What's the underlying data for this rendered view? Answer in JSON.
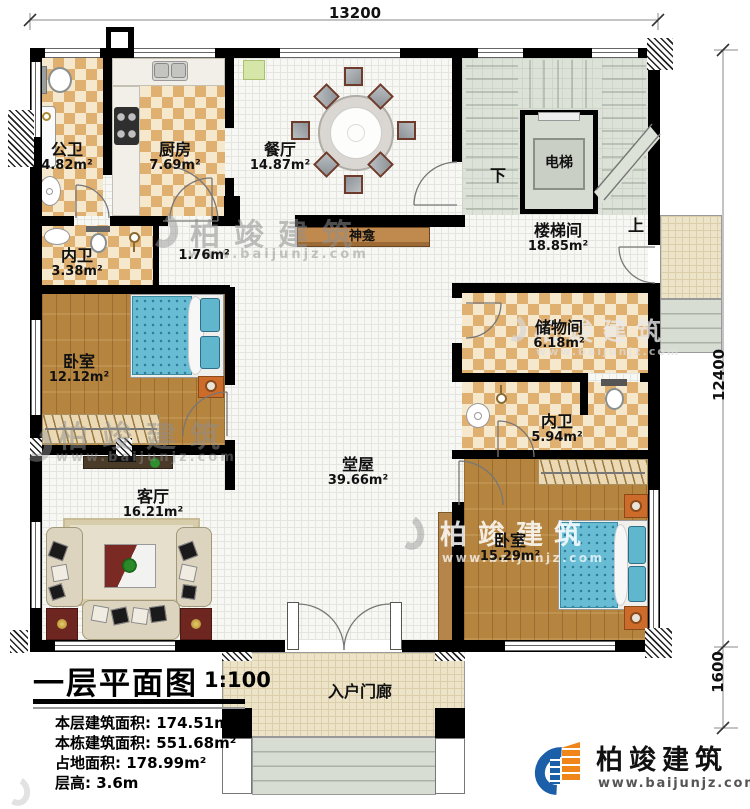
{
  "dimensions": {
    "top": "13200",
    "side": "12400",
    "porch": "1600"
  },
  "rooms": {
    "gongwei": {
      "name": "公卫",
      "area": "4.82m²"
    },
    "chufang": {
      "name": "厨房",
      "area": "7.69m²"
    },
    "canting": {
      "name": "餐厅",
      "area": "14.87m²"
    },
    "neiwei1": {
      "name": "内卫",
      "area": "3.38m²"
    },
    "shenkan": {
      "name": "神龛",
      "area": "1.76m²"
    },
    "woshi1": {
      "name": "卧室",
      "area": "12.12m²"
    },
    "keting": {
      "name": "客厅",
      "area": "16.21m²"
    },
    "tangwu": {
      "name": "堂屋",
      "area": "39.66m²"
    },
    "loutijian": {
      "name": "楼梯间",
      "area": "18.85m²"
    },
    "dianti": {
      "name": "电梯"
    },
    "chuwujian": {
      "name": "储物间",
      "area": "6.18m²"
    },
    "neiwei2": {
      "name": "内卫",
      "area": "5.94m²"
    },
    "woshi2": {
      "name": "卧室",
      "area": "15.29m²"
    },
    "menlang": {
      "name": "入户门廊"
    }
  },
  "stairs": {
    "up": "上",
    "down": "下"
  },
  "title_block": {
    "title": "一层平面图",
    "scale": "1:100",
    "items": [
      {
        "label": "本层建筑面积:",
        "value": "174.51m²"
      },
      {
        "label": "本栋建筑面积:",
        "value": "551.68m²"
      },
      {
        "label": "占地面积:",
        "value": "178.99m²"
      },
      {
        "label": "层高:",
        "value": "3.6m"
      }
    ]
  },
  "brand": {
    "name": "柏竣建筑",
    "website": "www.baijunjz.com"
  },
  "watermark": {
    "name": "柏竣建筑",
    "website": "www.baijunjz.com"
  },
  "colors": {
    "wall": "#000000",
    "checker_dark": "#e0b071",
    "checker_light": "#f6e8cd",
    "wood": "#b5843f",
    "stair_floor": "#dce2d7",
    "porch_floor": "#ece3c8",
    "brand_blue": "#1a5fa8",
    "brand_orange": "#f08519",
    "bed_blue": "#6cc0d8",
    "accent_red": "#7a2a22"
  }
}
